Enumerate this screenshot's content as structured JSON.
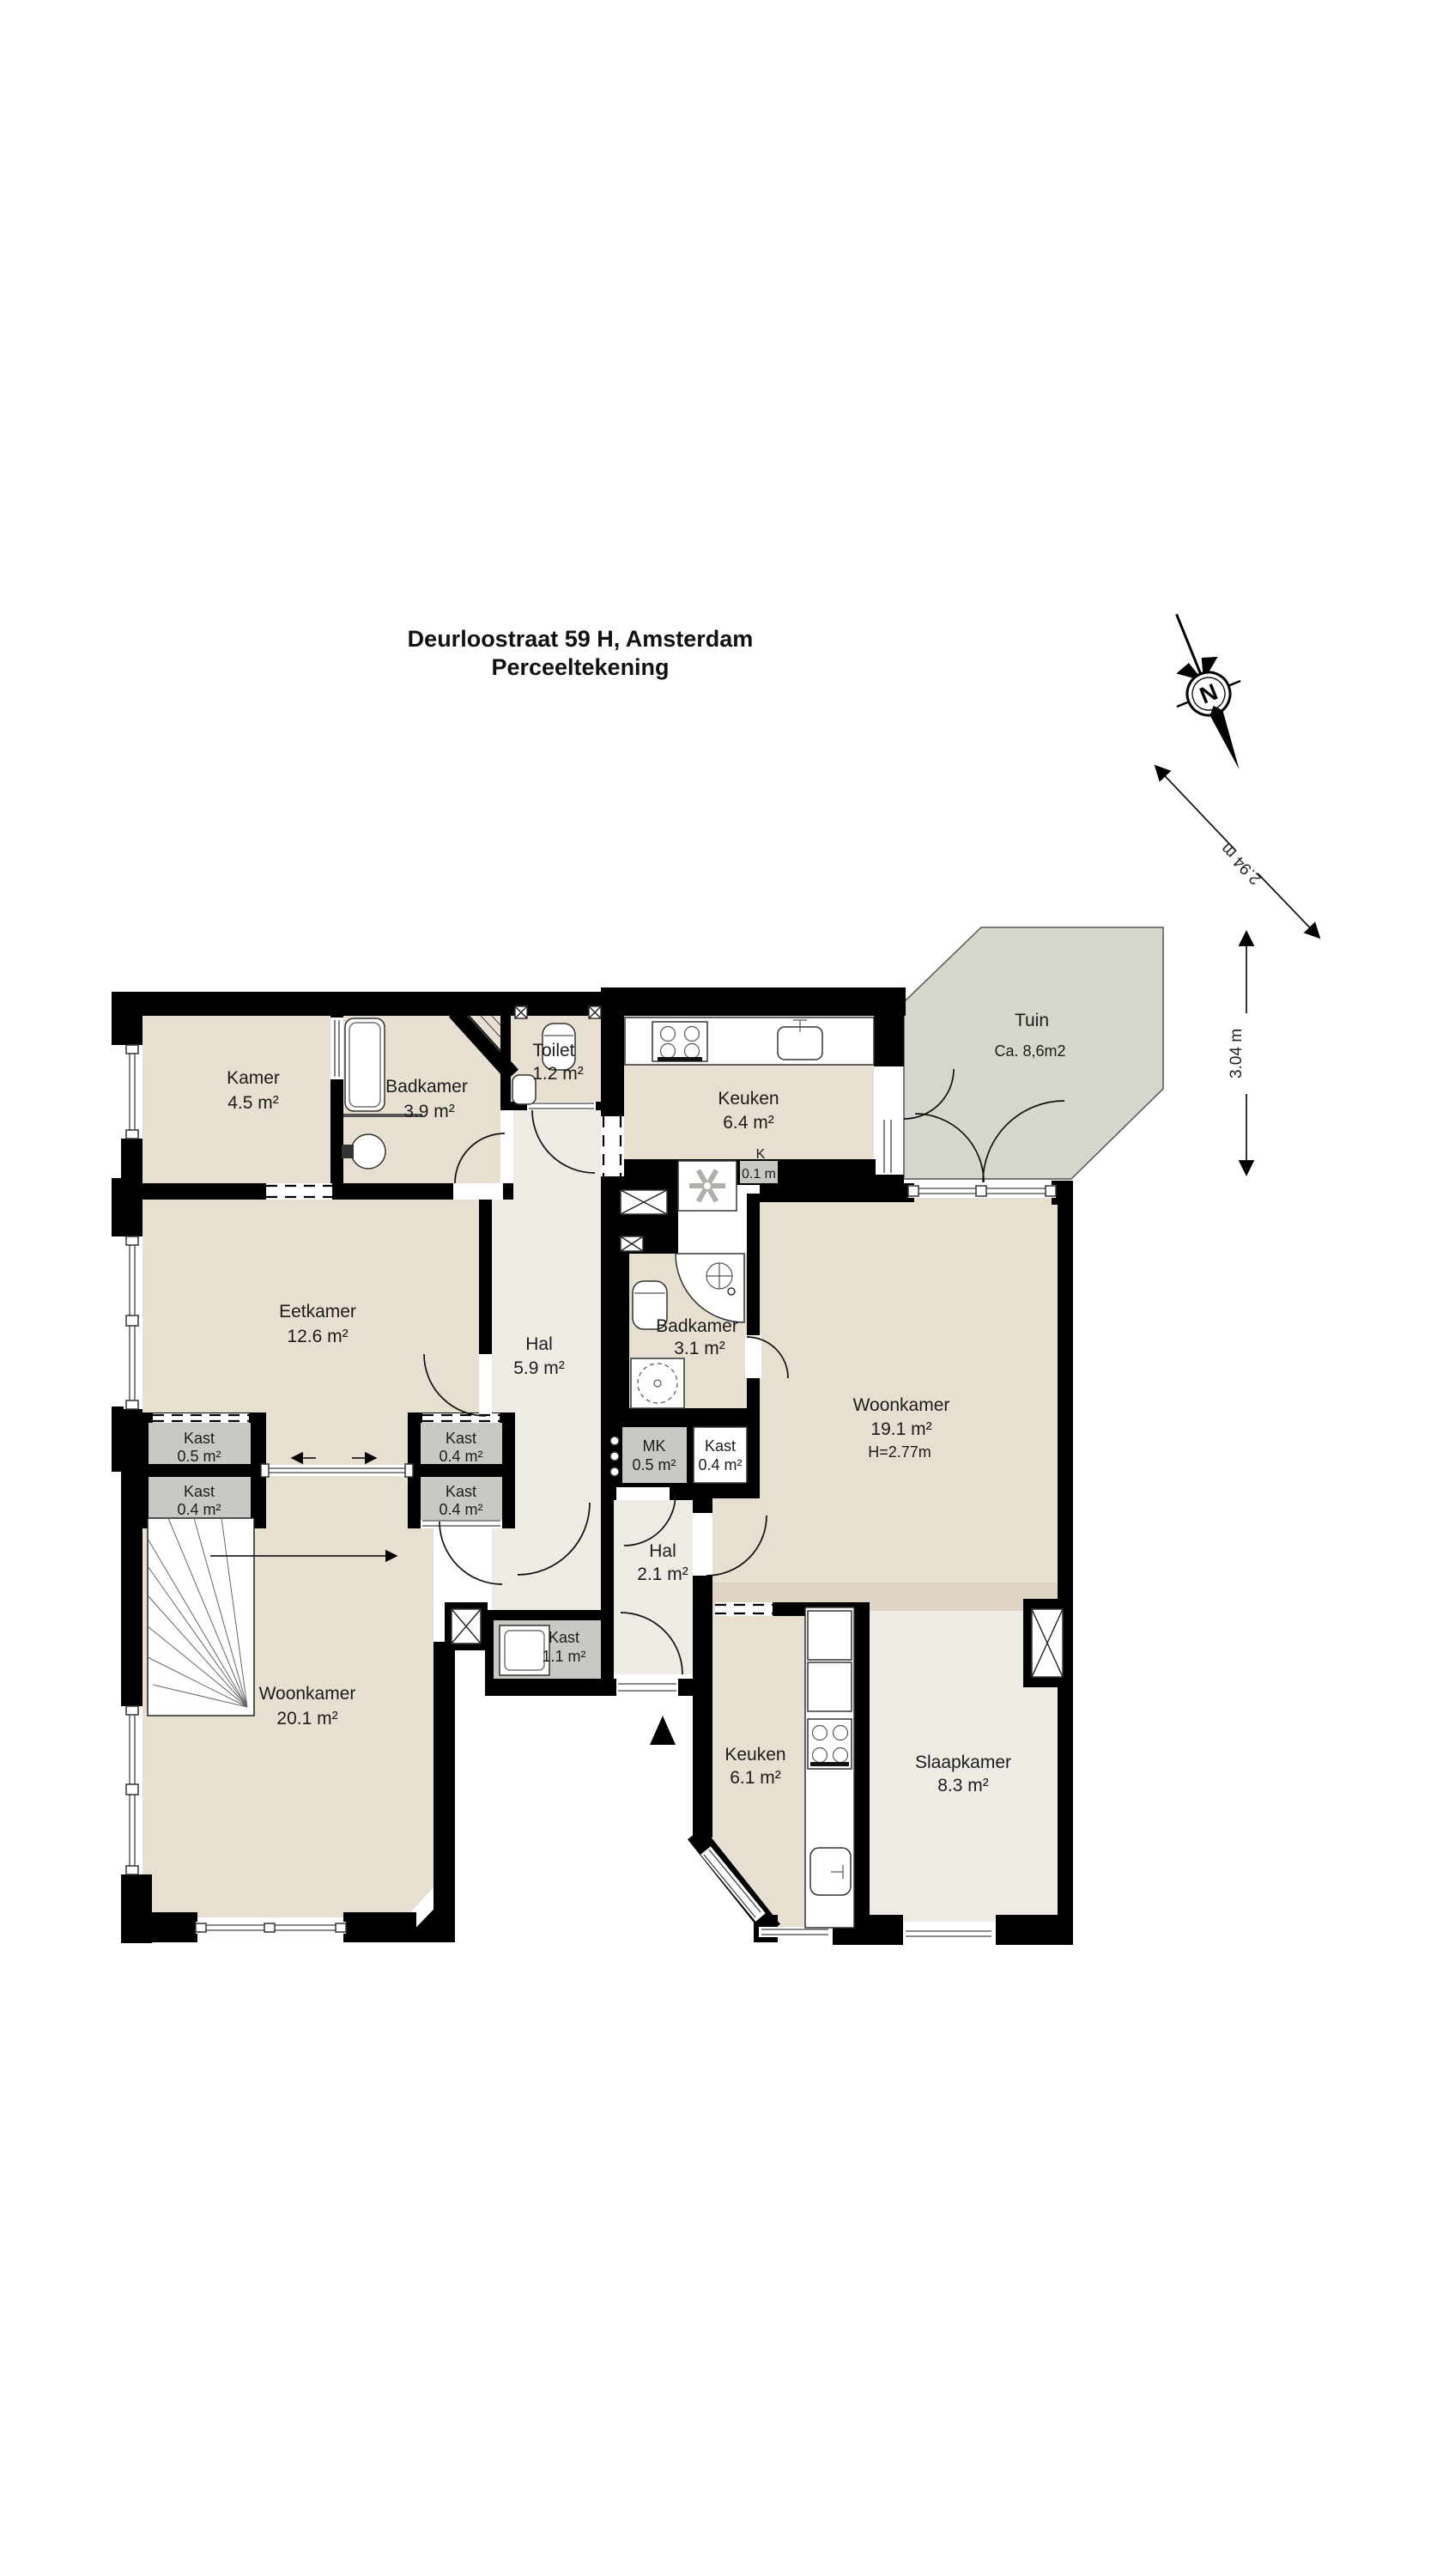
{
  "title": {
    "line1": "Deurloostraat 59 H, Amsterdam",
    "line2": "Perceeltekening"
  },
  "compass": {
    "north_label": "N"
  },
  "measurements": {
    "diagonal": "2.94 m",
    "vertical": "3.04 m"
  },
  "rooms": [
    {
      "id": "kamer",
      "name": "Kamer",
      "area": "4.5 m²"
    },
    {
      "id": "badkamer-boven",
      "name": "Badkamer",
      "area": "3.9 m²"
    },
    {
      "id": "toilet",
      "name": "Toilet",
      "area": "1.2 m²"
    },
    {
      "id": "keuken-boven",
      "name": "Keuken",
      "area": "6.4 m²"
    },
    {
      "id": "k-kastje",
      "name": "K",
      "area": "0.1 m"
    },
    {
      "id": "tuin",
      "name": "Tuin",
      "area": "Ca. 8,6m2"
    },
    {
      "id": "eetkamer",
      "name": "Eetkamer",
      "area": "12.6 m²"
    },
    {
      "id": "hal-boven",
      "name": "Hal",
      "area": "5.9 m²"
    },
    {
      "id": "badkamer-midden",
      "name": "Badkamer",
      "area": "3.1 m²"
    },
    {
      "id": "kast-links-boven",
      "name": "Kast",
      "area": "0.5 m²"
    },
    {
      "id": "kast-links-onder",
      "name": "Kast",
      "area": "0.4 m²"
    },
    {
      "id": "kast-rechts-boven",
      "name": "Kast",
      "area": "0.4 m²"
    },
    {
      "id": "kast-rechts-onder",
      "name": "Kast",
      "area": "0.4 m²"
    },
    {
      "id": "mk",
      "name": "MK",
      "area": "0.5 m²"
    },
    {
      "id": "kast-midden",
      "name": "Kast",
      "area": "0.4 m²"
    },
    {
      "id": "woonkamer-rechts",
      "name": "Woonkamer",
      "area": "19.1 m²",
      "note": "H=2.77m"
    },
    {
      "id": "kast-hal",
      "name": "Kast",
      "area": "1.1 m²"
    },
    {
      "id": "hal-onder",
      "name": "Hal",
      "area": "2.1 m²"
    },
    {
      "id": "woonkamer-links",
      "name": "Woonkamer",
      "area": "20.1 m²"
    },
    {
      "id": "keuken-onder",
      "name": "Keuken",
      "area": "6.1 m²"
    },
    {
      "id": "slaapkamer",
      "name": "Slaapkamer",
      "area": "8.3 m²"
    }
  ],
  "colors": {
    "wall": "#000000",
    "room_fill": "#e7dfcf",
    "hall_fill": "#edebe4",
    "garden_fill": "#d7d6cc",
    "closet_fill": "#c9c9c4",
    "shade_fill": "#ded5c4"
  }
}
